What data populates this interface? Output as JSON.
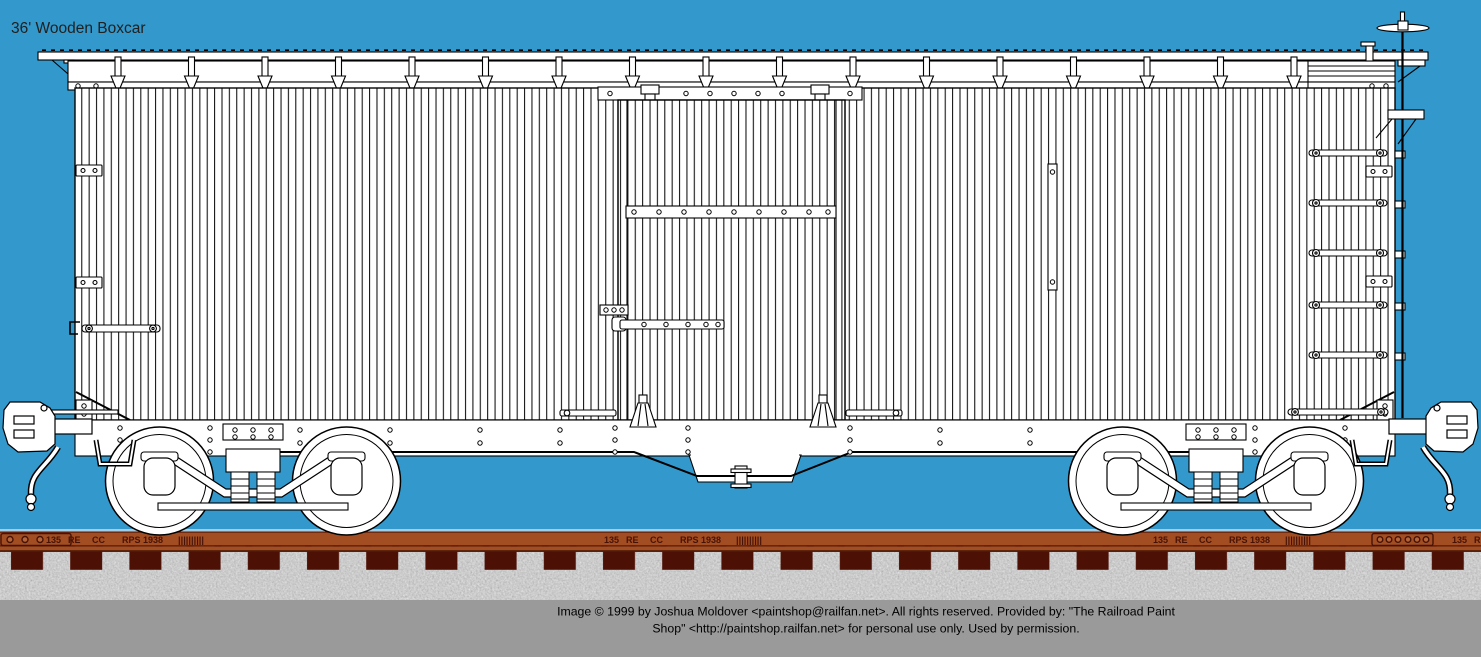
{
  "title": "36' Wooden Boxcar",
  "colors": {
    "background": "#3399CC",
    "title_text": "#202020",
    "line": "#000000",
    "car_fill": "#FFFFFF",
    "rail": "#A34E22",
    "rail_dark_edge": "#5A1C08",
    "rail_text": "#471206",
    "rail_shine": "#A9CBDF",
    "tie": "#4D1005",
    "ballast": "#9E9E9E",
    "footer_bg": "#9A9A9A",
    "footer_text": "#000000"
  },
  "rail_marking": {
    "tokens": [
      "135",
      "RE",
      "CC",
      "RPS",
      "1938"
    ],
    "hash_marks": "||||||||||"
  },
  "footer": {
    "line1": "Image © 1999 by Joshua Moldover <paintshop@railfan.net>.  All rights reserved.  Provided by: \"The Railroad Paint",
    "line2": "Shop\" <http://paintshop.railfan.net> for personal use only.  Used by permission."
  }
}
